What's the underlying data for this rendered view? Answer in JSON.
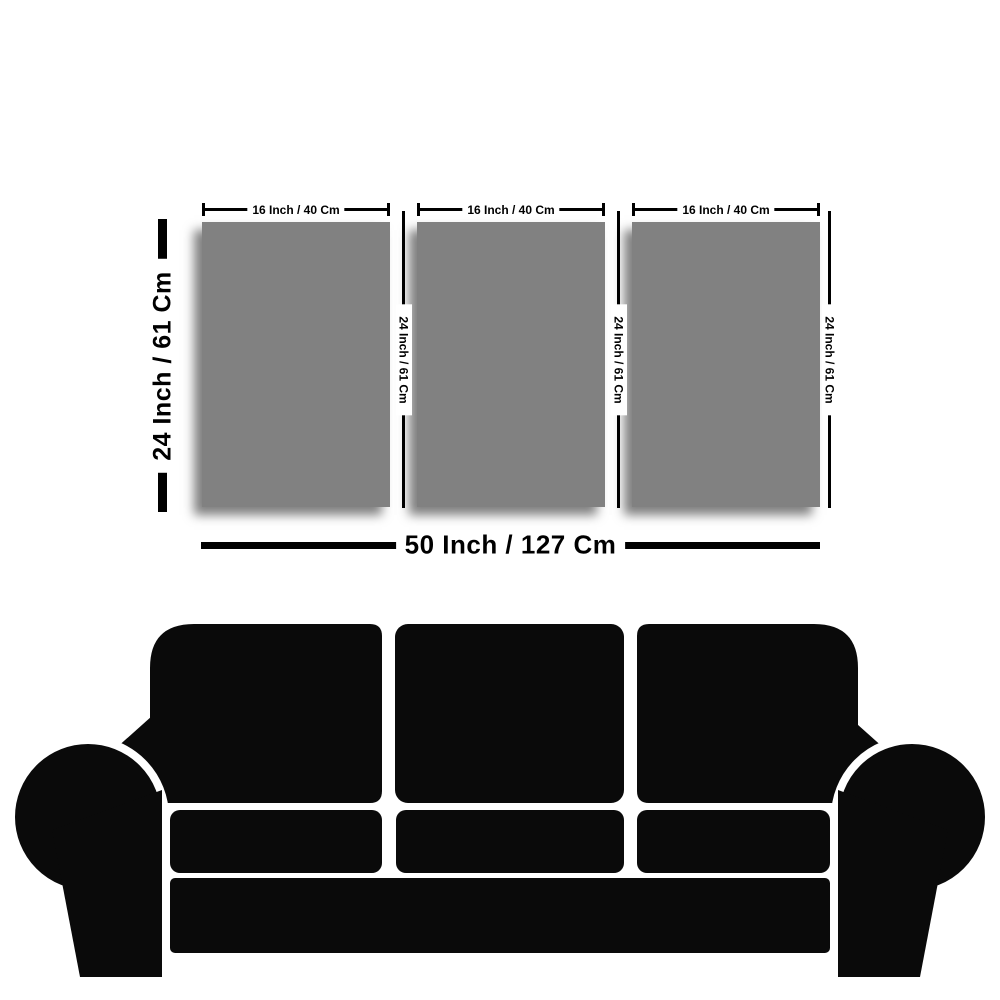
{
  "diagram": {
    "panels": [
      {
        "width_label": "16 Inch / 40 Cm",
        "height_label": "24 Inch / 61 Cm"
      },
      {
        "width_label": "16 Inch / 40 Cm",
        "height_label": "24 Inch / 61 Cm"
      },
      {
        "width_label": "16 Inch / 40 Cm",
        "height_label": "24 Inch / 61 Cm"
      }
    ],
    "set_height_label": "24 Inch / 61 Cm",
    "total_width_label": "50 Inch / 127 Cm",
    "colors": {
      "background": "#ffffff",
      "ink": "#000000",
      "panel_fill": "#818181",
      "sofa": "#0a0a0a"
    }
  }
}
